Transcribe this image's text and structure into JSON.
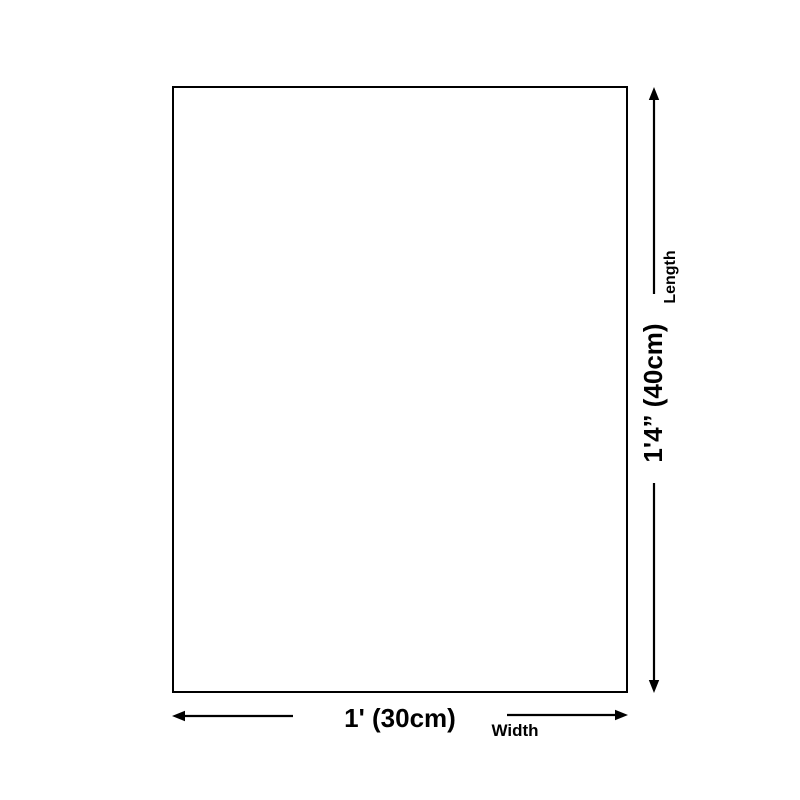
{
  "diagram": {
    "background_color": "#ffffff",
    "line_color": "#000000",
    "length": {
      "value": "1'4” (40cm)",
      "axis_label": "Length"
    },
    "width": {
      "value": "1' (30cm)",
      "axis_label": "Width"
    }
  }
}
